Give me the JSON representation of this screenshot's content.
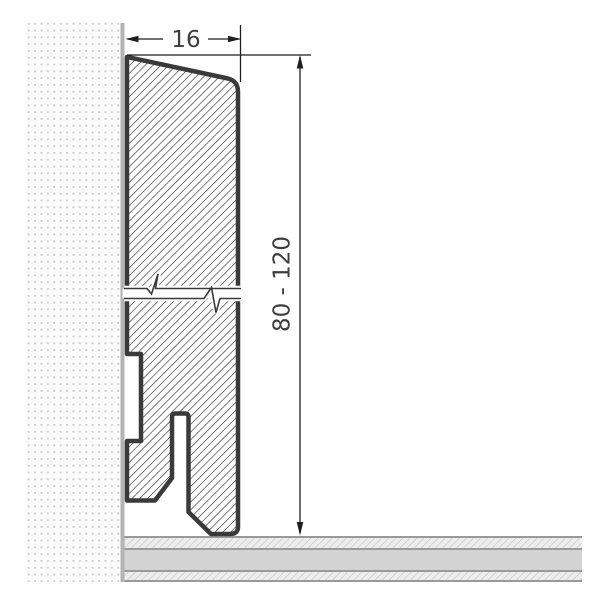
{
  "diagram": {
    "labels": {
      "width_dimension": "16",
      "height_dimension": "80 - 120"
    },
    "colors": {
      "profile_outline": "#3a3a3a",
      "hatch_line": "#2e2e2e",
      "dimension_line": "#1f1f1f",
      "label_text": "#3d3d3d",
      "wall_background": "#fbfbfb",
      "wall_dot": "#c9c9c9",
      "wall_edge_strip": "#b3b3b3",
      "floor_border": "#9a9a9a",
      "floor_solid": "#d3d3d3",
      "floor_hatch_background": "#ededed",
      "floor_hatch_line": "#c0c0c0",
      "page_background": "#ffffff"
    }
  }
}
